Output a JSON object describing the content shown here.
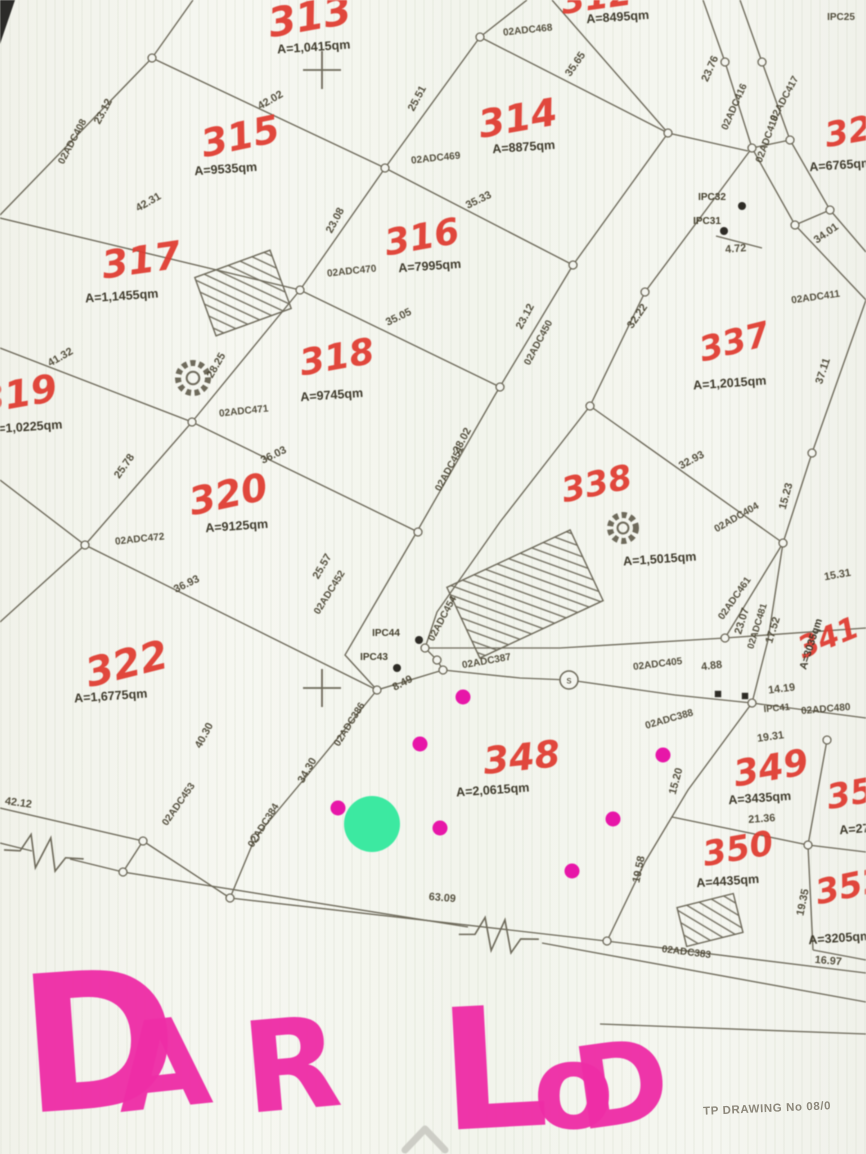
{
  "title": "cadastral-parcel-map-scan",
  "colors": {
    "paper": "#f4f5ef",
    "line": "#6e6a5b",
    "map_text": "#46412f",
    "parcel_red": "#df3a2f",
    "handwriting_pink": "#ee2da6",
    "magenta_dot": "#e716a8",
    "green_dot": "#3ce9a1",
    "footer_gray": "#8d887b",
    "chevron_gray": "#cdcdc6"
  },
  "map": {
    "parcels": [
      {
        "number": "313",
        "nx": 312,
        "ny": 30,
        "nrot": -10,
        "nsize": 40,
        "area": "A=1,0415qm",
        "ax": 314,
        "ay": 51,
        "arot": -4
      },
      {
        "number": "312",
        "nx": 598,
        "ny": 9,
        "nrot": -8,
        "nsize": 34,
        "area": "A=8495qm",
        "ax": 618,
        "ay": 21,
        "arot": -4
      },
      {
        "number": "315",
        "nx": 243,
        "ny": 149,
        "nrot": -12,
        "nsize": 38,
        "area": "A=9535qm",
        "ax": 226,
        "ay": 173,
        "arot": -4
      },
      {
        "number": "314",
        "nx": 520,
        "ny": 131,
        "nrot": -10,
        "nsize": 38,
        "area": "A=8875qm",
        "ax": 524,
        "ay": 151,
        "arot": -4
      },
      {
        "number": "316",
        "nx": 424,
        "ny": 249,
        "nrot": -10,
        "nsize": 36,
        "area": "A=7995qm",
        "ax": 430,
        "ay": 270,
        "arot": -4
      },
      {
        "number": "317",
        "nx": 143,
        "ny": 273,
        "nrot": -8,
        "nsize": 38,
        "area": "A=1,1455qm",
        "ax": 122,
        "ay": 300,
        "arot": -4
      },
      {
        "number": "318",
        "nx": 339,
        "ny": 369,
        "nrot": -10,
        "nsize": 36,
        "area": "A=9745qm",
        "ax": 332,
        "ay": 399,
        "arot": -4
      },
      {
        "number": "319",
        "nx": 20,
        "ny": 407,
        "nrot": -10,
        "nsize": 38,
        "area": "A=1,0225qm",
        "ax": 26,
        "ay": 431,
        "arot": -4
      },
      {
        "number": "320",
        "nx": 231,
        "ny": 507,
        "nrot": -12,
        "nsize": 38,
        "area": "A=9125qm",
        "ax": 237,
        "ay": 530,
        "arot": -4
      },
      {
        "number": "322",
        "nx": 130,
        "ny": 677,
        "nrot": -14,
        "nsize": 40,
        "area": "A=1,6775qm",
        "ax": 111,
        "ay": 700,
        "arot": -4
      },
      {
        "number": "321",
        "nx": 862,
        "ny": 141,
        "nrot": -10,
        "nsize": 34,
        "area": "A=6765qm",
        "ax": 841,
        "ay": 169,
        "arot": -4
      },
      {
        "number": "337",
        "nx": 737,
        "ny": 353,
        "nrot": -14,
        "nsize": 34,
        "area": "A=1,2015qm",
        "ax": 730,
        "ay": 387,
        "arot": -4
      },
      {
        "number": "338",
        "nx": 599,
        "ny": 495,
        "nrot": -12,
        "nsize": 34,
        "area": "A=1,5015qm",
        "ax": 660,
        "ay": 563,
        "arot": -4
      },
      {
        "number": "341",
        "nx": 832,
        "ny": 647,
        "nrot": -22,
        "nsize": 30,
        "area": "A=3035qm",
        "ax": 814,
        "ay": 645,
        "arot": -72,
        "asize": 10.5
      },
      {
        "number": "348",
        "nx": 523,
        "ny": 770,
        "nrot": -6,
        "nsize": 37,
        "area": "A=2,0615qm",
        "ax": 493,
        "ay": 794,
        "arot": -4
      },
      {
        "number": "349",
        "nx": 773,
        "ny": 780,
        "nrot": -10,
        "nsize": 36,
        "area": "A=3435qm",
        "ax": 760,
        "ay": 802,
        "arot": -4
      },
      {
        "number": "350",
        "nx": 740,
        "ny": 860,
        "nrot": -10,
        "nsize": 34,
        "area": "A=4435qm",
        "ax": 728,
        "ay": 885,
        "arot": -4
      },
      {
        "number": "351",
        "nx": 864,
        "ny": 803,
        "nrot": -10,
        "nsize": 34,
        "area": "A=2775qm",
        "ax": 871,
        "ay": 832,
        "arot": -4
      },
      {
        "number": "352",
        "nx": 853,
        "ny": 897,
        "nrot": -12,
        "nsize": 34,
        "area": "A=3205qm",
        "ax": 840,
        "ay": 942,
        "arot": -4
      }
    ],
    "edge_labels": [
      {
        "t": "42.02",
        "x": 272,
        "y": 103,
        "r": -30
      },
      {
        "t": "25.51",
        "x": 420,
        "y": 100,
        "r": -62
      },
      {
        "t": "23.12",
        "x": 106,
        "y": 113,
        "r": -62
      },
      {
        "t": "02ADC408",
        "x": 75,
        "y": 143,
        "r": -62,
        "s": 10
      },
      {
        "t": "42.31",
        "x": 150,
        "y": 205,
        "r": -30
      },
      {
        "t": "23.08",
        "x": 338,
        "y": 222,
        "r": -62
      },
      {
        "t": "35.33",
        "x": 480,
        "y": 203,
        "r": -26
      },
      {
        "t": "35.65",
        "x": 578,
        "y": 66,
        "r": -55
      },
      {
        "t": "23.76",
        "x": 713,
        "y": 70,
        "r": -66
      },
      {
        "t": "02ADC416",
        "x": 737,
        "y": 108,
        "r": -66,
        "s": 10
      },
      {
        "t": "02ADC417",
        "x": 787,
        "y": 100,
        "r": -62,
        "s": 10
      },
      {
        "t": "02ADC418",
        "x": 770,
        "y": 140,
        "r": -70,
        "s": 10
      },
      {
        "t": "IPC25",
        "x": 841,
        "y": 20,
        "r": 0,
        "s": 10
      },
      {
        "t": "34.01",
        "x": 828,
        "y": 236,
        "r": -35
      },
      {
        "t": "4.72",
        "x": 736,
        "y": 252,
        "r": -5
      },
      {
        "t": "02ADC411",
        "x": 816,
        "y": 300,
        "r": -8,
        "s": 10
      },
      {
        "t": "02ADC468",
        "x": 528,
        "y": 33,
        "r": -6,
        "s": 10
      },
      {
        "t": "02ADC469",
        "x": 436,
        "y": 161,
        "r": -6,
        "s": 10
      },
      {
        "t": "02ADC470",
        "x": 352,
        "y": 274,
        "r": -6,
        "s": 10
      },
      {
        "t": "02ADC471",
        "x": 244,
        "y": 414,
        "r": -6,
        "s": 10
      },
      {
        "t": "02ADC472",
        "x": 140,
        "y": 542,
        "r": -6,
        "s": 10
      },
      {
        "t": "35.05",
        "x": 400,
        "y": 320,
        "r": -26
      },
      {
        "t": "23.12",
        "x": 528,
        "y": 318,
        "r": -62
      },
      {
        "t": "02ADC450",
        "x": 541,
        "y": 344,
        "r": -62,
        "s": 10
      },
      {
        "t": "32.22",
        "x": 640,
        "y": 318,
        "r": -55
      },
      {
        "t": "37.11",
        "x": 826,
        "y": 372,
        "r": -72
      },
      {
        "t": "28.02",
        "x": 465,
        "y": 442,
        "r": -62
      },
      {
        "t": "02ADC451",
        "x": 452,
        "y": 470,
        "r": -62,
        "s": 10
      },
      {
        "t": "36.03",
        "x": 275,
        "y": 458,
        "r": -26
      },
      {
        "t": "41.32",
        "x": 62,
        "y": 360,
        "r": -30
      },
      {
        "t": "28.25",
        "x": 219,
        "y": 367,
        "r": -60
      },
      {
        "t": "25.78",
        "x": 127,
        "y": 468,
        "r": -55
      },
      {
        "t": "32.93",
        "x": 693,
        "y": 463,
        "r": -28
      },
      {
        "t": "15.23",
        "x": 789,
        "y": 497,
        "r": -75
      },
      {
        "t": "02ADC404",
        "x": 738,
        "y": 520,
        "r": -30,
        "s": 10
      },
      {
        "t": "36.93",
        "x": 188,
        "y": 587,
        "r": -26
      },
      {
        "t": "25.57",
        "x": 325,
        "y": 568,
        "r": -60
      },
      {
        "t": "02ADC452",
        "x": 332,
        "y": 594,
        "r": -58,
        "s": 10
      },
      {
        "t": "02ADC454",
        "x": 445,
        "y": 620,
        "r": -62,
        "s": 10
      },
      {
        "t": "23.07",
        "x": 745,
        "y": 622,
        "r": -73
      },
      {
        "t": "02ADC481",
        "x": 760,
        "y": 627,
        "r": -73,
        "s": 9.5
      },
      {
        "t": "17.52",
        "x": 776,
        "y": 631,
        "r": -73
      },
      {
        "t": "15.31",
        "x": 838,
        "y": 578,
        "r": -10
      },
      {
        "t": "02ADC461",
        "x": 737,
        "y": 600,
        "r": -55,
        "s": 10
      },
      {
        "t": "02ADC405",
        "x": 658,
        "y": 667,
        "r": -7,
        "s": 10
      },
      {
        "t": "4.88",
        "x": 712,
        "y": 669,
        "r": -7
      },
      {
        "t": "8.49",
        "x": 404,
        "y": 686,
        "r": -28
      },
      {
        "t": "02ADC387",
        "x": 487,
        "y": 664,
        "r": -10,
        "s": 10
      },
      {
        "t": "IPC41",
        "x": 777,
        "y": 711,
        "r": -5,
        "s": 9.5
      },
      {
        "t": "02ADC480",
        "x": 826,
        "y": 712,
        "r": -5,
        "s": 10
      },
      {
        "t": "14.19",
        "x": 782,
        "y": 692,
        "r": -7
      },
      {
        "t": "19.31",
        "x": 771,
        "y": 740,
        "r": -8
      },
      {
        "t": "40.30",
        "x": 207,
        "y": 737,
        "r": -62
      },
      {
        "t": "34.30",
        "x": 310,
        "y": 772,
        "r": -60
      },
      {
        "t": "02ADC386",
        "x": 352,
        "y": 726,
        "r": -58,
        "s": 10
      },
      {
        "t": "02ADC384",
        "x": 266,
        "y": 827,
        "r": -58,
        "s": 10
      },
      {
        "t": "02ADC453",
        "x": 181,
        "y": 806,
        "r": -55,
        "s": 10
      },
      {
        "t": "42.12",
        "x": 18,
        "y": 806,
        "r": 8
      },
      {
        "t": "63.09",
        "x": 442,
        "y": 901,
        "r": 5
      },
      {
        "t": "02ADC383",
        "x": 686,
        "y": 955,
        "r": 7,
        "s": 10
      },
      {
        "t": "02ADC388",
        "x": 670,
        "y": 722,
        "r": -16,
        "s": 10
      },
      {
        "t": "15.20",
        "x": 679,
        "y": 782,
        "r": -75
      },
      {
        "t": "19.58",
        "x": 642,
        "y": 870,
        "r": -78
      },
      {
        "t": "19.35",
        "x": 806,
        "y": 903,
        "r": -78
      },
      {
        "t": "21.36",
        "x": 762,
        "y": 822,
        "r": -4
      },
      {
        "t": "16.97",
        "x": 828,
        "y": 964,
        "r": 5
      }
    ],
    "ipc_points": [
      {
        "t": "IPC44",
        "x": 386,
        "y": 636,
        "dx": 419,
        "dy": 640
      },
      {
        "t": "IPC43",
        "x": 374,
        "y": 660,
        "dx": 397,
        "dy": 668
      },
      {
        "t": "IPC32",
        "x": 712,
        "y": 200,
        "dx": 742,
        "dy": 206
      },
      {
        "t": "IPC31",
        "x": 707,
        "y": 224,
        "dx": 724,
        "dy": 231
      }
    ],
    "black_dots": [
      [
        718,
        694
      ],
      [
        745,
        696
      ]
    ],
    "polylines": [
      "193,0 152,58 0,215",
      "152,58 385,168 573,265",
      "480,37 385,168 300,290 192,422 85,545 0,622",
      "527,0 480,37",
      "480,37 668,133 748,151",
      "552,0 668,133",
      "573,265 668,133",
      "0,218 300,290 500,387",
      "0,348 192,422 418,532",
      "0,480 85,545 377,690",
      "573,265 495,395 415,535 345,655 377,690",
      "703,0 725,62 752,148 795,225 866,300",
      "740,0 762,62 790,140 830,210 866,252",
      "752,148 790,140",
      "795,225 830,210",
      "716,236 762,248",
      "752,148 645,292 590,406",
      "590,406 500,522 437,612 425,648",
      "425,648 437,660 443,670",
      "443,670 377,690",
      "590,406 783,543",
      "866,300 812,453 783,543",
      "425,648 560,648 725,638 866,628",
      "725,638 783,543",
      "783,543 768,640 752,703",
      "443,670 520,678 569,680 675,695 752,703",
      "752,703 866,718",
      "752,703 688,790 645,862 607,941",
      "672,817 808,845 866,852",
      "827,740 808,845 813,950",
      "813,950 866,960",
      "377,690 310,772 255,838 230,898",
      "0,808 143,841",
      "0,843 32,851",
      "70,859 123,872",
      "123,872 143,841",
      "143,841 230,898",
      "230,898 606,941",
      "606,941 866,973",
      "123,872 468,927",
      "542,943 866,1002",
      "600,1024 866,1034"
    ],
    "nodes": [
      [
        152,
        58
      ],
      [
        480,
        37
      ],
      [
        385,
        168
      ],
      [
        300,
        290
      ],
      [
        192,
        422
      ],
      [
        85,
        545
      ],
      [
        668,
        133
      ],
      [
        752,
        148
      ],
      [
        573,
        265
      ],
      [
        500,
        387
      ],
      [
        418,
        532
      ],
      [
        425,
        648
      ],
      [
        437,
        660
      ],
      [
        443,
        670
      ],
      [
        377,
        690
      ],
      [
        590,
        406
      ],
      [
        645,
        292
      ],
      [
        812,
        453
      ],
      [
        783,
        543
      ],
      [
        725,
        638
      ],
      [
        752,
        703
      ],
      [
        808,
        845
      ],
      [
        827,
        740
      ],
      [
        607,
        941
      ],
      [
        255,
        838
      ],
      [
        230,
        898
      ],
      [
        143,
        841
      ],
      [
        123,
        872
      ],
      [
        762,
        62
      ],
      [
        725,
        62
      ],
      [
        795,
        225
      ],
      [
        830,
        210
      ],
      [
        790,
        140
      ]
    ],
    "crosses": [
      [
        322,
        70
      ],
      [
        322,
        688
      ]
    ],
    "gear_symbols": [
      [
        193,
        378,
        15
      ],
      [
        623,
        528,
        13
      ]
    ],
    "manhole": {
      "x": 569,
      "y": 680,
      "r": 9,
      "label": "s"
    },
    "hatches": [
      {
        "cx": 243,
        "cy": 293,
        "w": 80,
        "h": 62,
        "rot": -20
      },
      {
        "cx": 525,
        "cy": 594,
        "w": 136,
        "h": 78,
        "rot": -25
      },
      {
        "cx": 710,
        "cy": 920,
        "w": 58,
        "h": 40,
        "rot": -14
      }
    ],
    "zigzags": [
      {
        "cx": 505,
        "cy": 936,
        "rot": 7
      },
      {
        "cx": 50,
        "cy": 854,
        "rot": 10
      }
    ],
    "markers": {
      "green": {
        "x": 372,
        "y": 824,
        "r": 28
      },
      "magenta_r": 7.5,
      "magenta": [
        [
          420,
          744
        ],
        [
          463,
          697
        ],
        [
          338,
          808
        ],
        [
          440,
          828
        ],
        [
          613,
          819
        ],
        [
          663,
          755
        ],
        [
          572,
          871
        ]
      ]
    },
    "handwriting": {
      "text": "DAR LOD",
      "letters": [
        {
          "ch": "D",
          "x": 25,
          "y": 1113,
          "size": 190,
          "rot": -4
        },
        {
          "ch": "A",
          "x": 120,
          "y": 1112,
          "size": 122,
          "rot": -6
        },
        {
          "ch": "R",
          "x": 247,
          "y": 1113,
          "size": 126,
          "rot": -5
        },
        {
          "ch": "L",
          "x": 443,
          "y": 1130,
          "size": 168,
          "rot": -3
        },
        {
          "ch": "o",
          "x": 533,
          "y": 1128,
          "size": 118,
          "rot": 0
        },
        {
          "ch": "D",
          "x": 580,
          "y": 1130,
          "size": 114,
          "rot": -8
        }
      ]
    }
  },
  "footer": {
    "drawing_no": "TP DRAWING No 08/0"
  },
  "chevron": {
    "label": "scroll-up-chevron"
  }
}
